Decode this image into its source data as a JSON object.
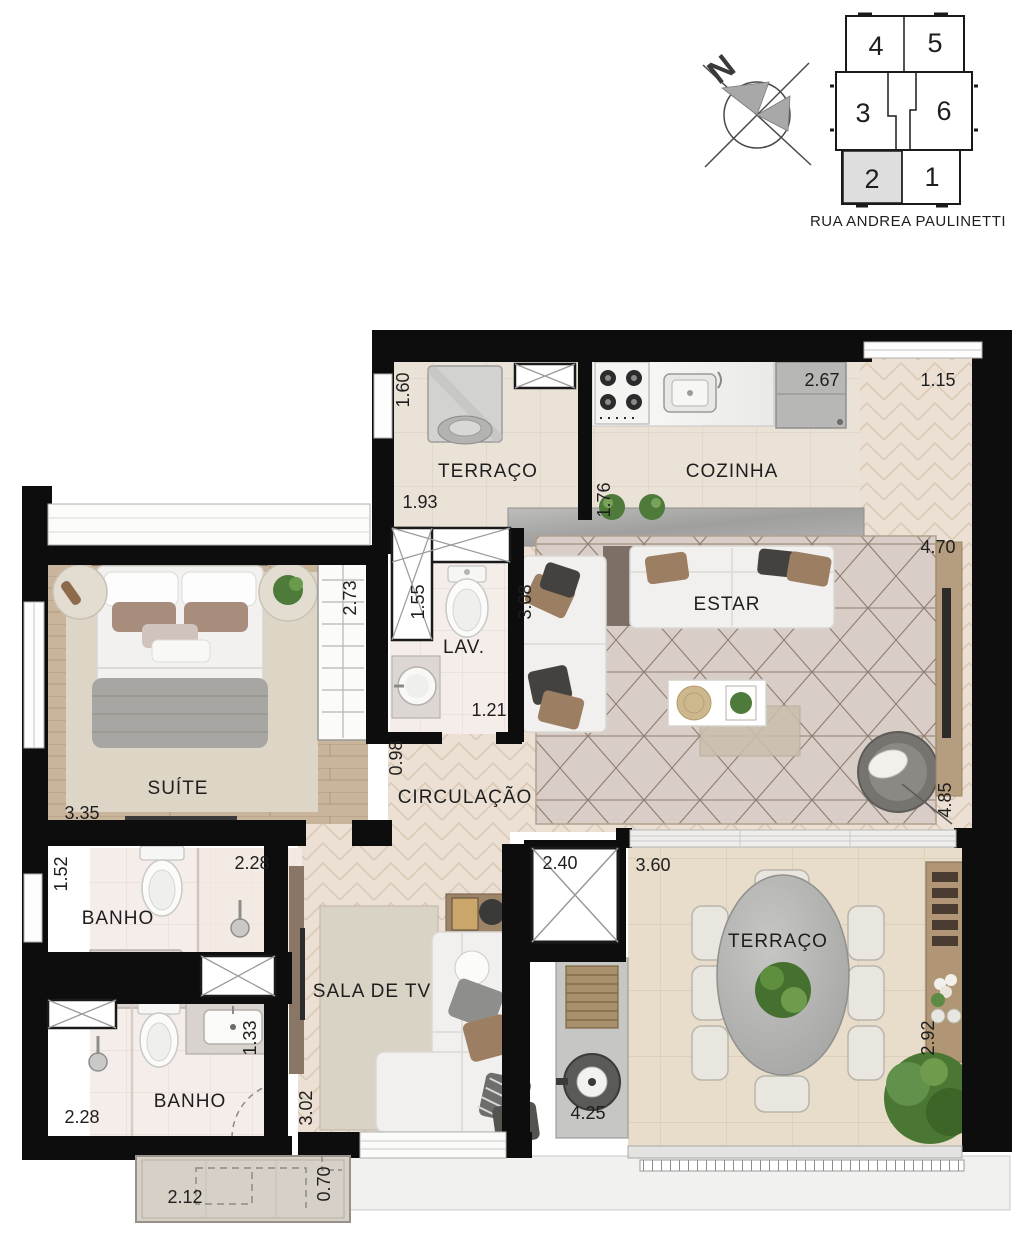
{
  "key_plan": {
    "street": "RUA ANDREA PAULINETTI",
    "highlighted_unit": "2",
    "units": [
      {
        "label": "4"
      },
      {
        "label": "5"
      },
      {
        "label": "3"
      },
      {
        "label": "6"
      },
      {
        "label": "2"
      },
      {
        "label": "1"
      }
    ]
  },
  "compass": {
    "north": "N"
  },
  "plan": {
    "rooms": {
      "service_terrace": "TERRAÇO",
      "kitchen": "COZINHA",
      "living": "ESTAR",
      "suite": "SUÍTE",
      "lav": "LAV.",
      "circulation": "CIRCULAÇÃO",
      "bath1": "BANHO",
      "bath2": "BANHO",
      "tv_room": "SALA DE TV",
      "terrace": "TERRAÇO"
    },
    "dims": {
      "service_terrace": {
        "w": "1.93",
        "h": "1.60"
      },
      "kitchen": {
        "w": "2.67",
        "pass": "1.76"
      },
      "varanda": {
        "w": "1.15"
      },
      "living": {
        "w": "4.70",
        "h": "4.85",
        "sofa": "3.08"
      },
      "suite": {
        "w": "3.35",
        "closet": "2.73"
      },
      "lav": {
        "h": "1.55",
        "w": "1.21"
      },
      "circulation": {
        "w": "0.98"
      },
      "bath1": {
        "h": "1.52",
        "w": "2.28"
      },
      "bath2": {
        "w": "2.28",
        "h": "1.33"
      },
      "tv_room": {
        "w": "2.40",
        "h": "3.02"
      },
      "grill": {
        "w": "4.25"
      },
      "terrace": {
        "w": "3.60",
        "h": "2.92"
      },
      "balcony": {
        "w": "2.12",
        "h": "0.70"
      }
    }
  },
  "colors": {
    "wall": "#0d0d0d",
    "tile_floor": "#ebe2d7",
    "wood_floor": "#c9b59c",
    "herringbone_floor": "#ebe0d3",
    "bath_floor": "#f5ede9",
    "terrace_tile": "#e8ddca",
    "highlighted_unit_fill": "#dedede",
    "plant_green": "#4e7a3a"
  }
}
